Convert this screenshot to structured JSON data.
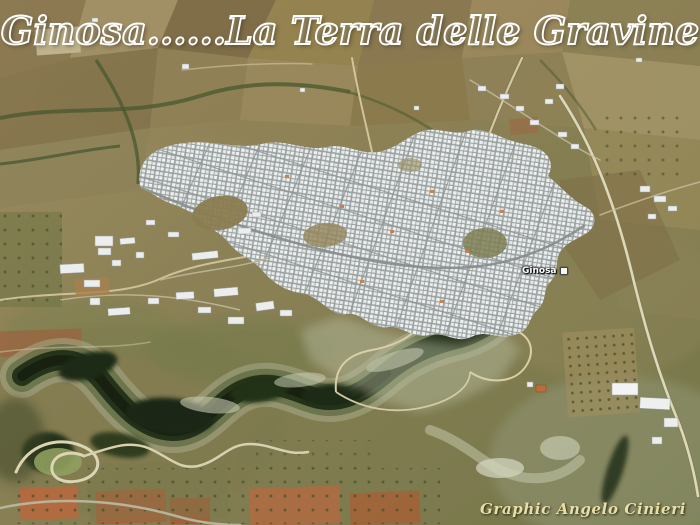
{
  "overlay": {
    "title": "Ginosa......La Terra delle Gravine",
    "credit": "Graphic Angelo Cinieri"
  },
  "map": {
    "place_label": "Ginosa",
    "place_marker_icon": "placemark-icon"
  },
  "scene": {
    "subject": "aerial view of the town of Ginosa with surrounding farmland and wooded ravine"
  },
  "palette": {
    "title_outline": "#ffffff",
    "credit_color": "#e9dfa6",
    "place_label_color": "#ffffff",
    "terrain_base": "#8c8156",
    "farmland_tan": "#a39067",
    "farmland_brown": "#7c6a45",
    "vegetation_green": "#4c5a31",
    "ravine_dark": "#26331b",
    "rock_light": "#a9ae8f",
    "town_white": "#edf0f1",
    "street_gray": "#99a09e",
    "tilled_red": "#b06a42",
    "road_tan": "#d3c9a2"
  }
}
